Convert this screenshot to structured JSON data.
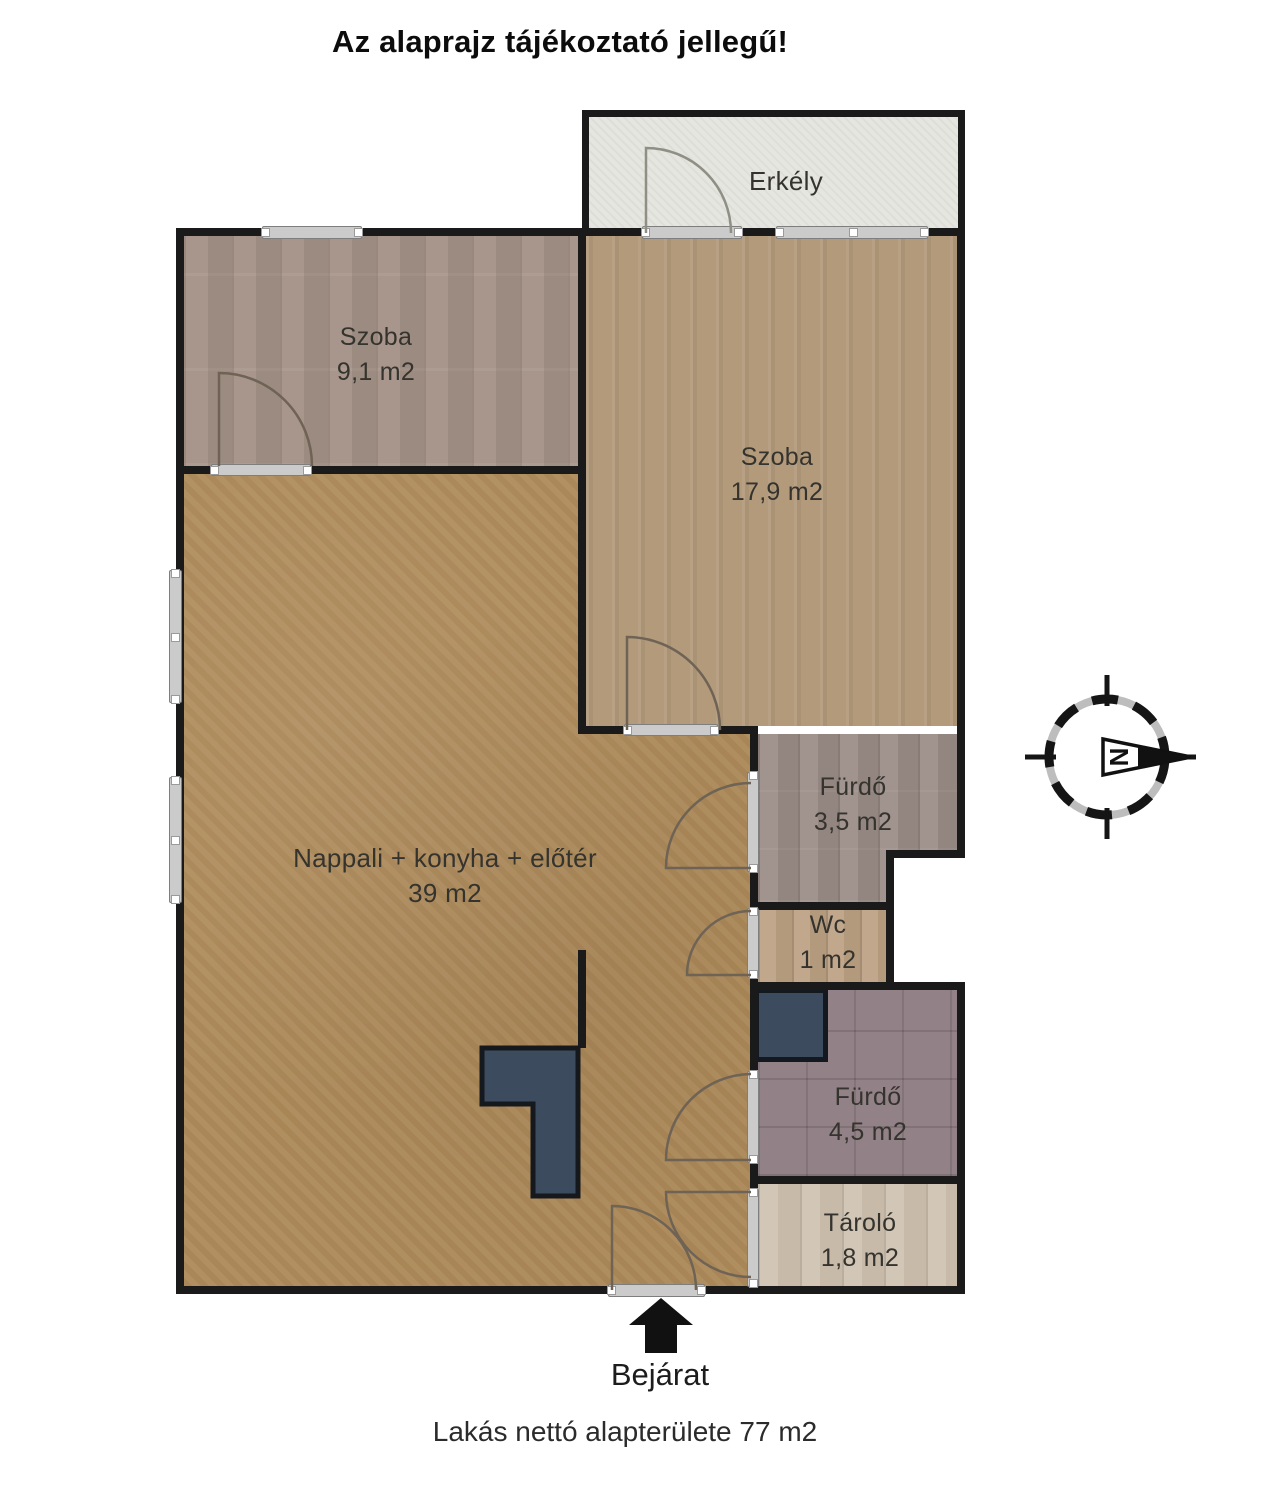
{
  "title": "Az alaprajz tájékoztató jellegű!",
  "rooms": {
    "erkely": {
      "name": "Erkély",
      "area": ""
    },
    "szoba1": {
      "name": "Szoba",
      "area": "9,1 m2"
    },
    "szoba2": {
      "name": "Szoba",
      "area": "17,9 m2"
    },
    "nappali": {
      "name": "Nappali + konyha + előtér",
      "area": "39 m2"
    },
    "furdo1": {
      "name": "Fürdő",
      "area": "3,5 m2"
    },
    "wc": {
      "name": "Wc",
      "area": "1 m2"
    },
    "furdo2": {
      "name": "Fürdő",
      "area": "4,5 m2"
    },
    "tarolo": {
      "name": "Tároló",
      "area": "1,8 m2"
    }
  },
  "entrance_label": "Bejárat",
  "footer": "Lakás nettó alapterülete 77 m2",
  "compass": {
    "letter": "N"
  },
  "colors": {
    "wall": "#1a1a1a",
    "floor_nappali": "#ad8a5a",
    "floor_szoba_small": "#a49287",
    "floor_szoba_large": "#b39a7b",
    "floor_erkely": "#e5e6df",
    "floor_furdo_35": "#9c8d87",
    "floor_wc": "#bda284",
    "floor_furdo_45": "#8e7d83",
    "floor_tarolo": "#cfc2b0",
    "kitchen_counter": "#3c4b5e",
    "window_bar": "#cbcbcb",
    "door_arc": "#6e6355"
  }
}
